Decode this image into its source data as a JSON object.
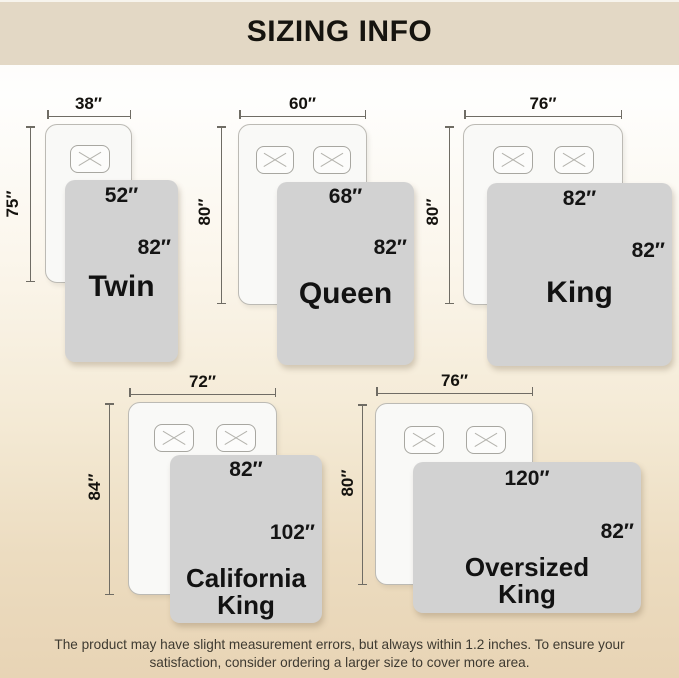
{
  "header": {
    "title": "SIZING INFO"
  },
  "sizes": [
    {
      "name": "Twin",
      "bed_width": "38″",
      "bed_height": "75″",
      "blanket_width": "52″",
      "blanket_height": "82″",
      "pillows": 1
    },
    {
      "name": "Queen",
      "bed_width": "60″",
      "bed_height": "80″",
      "blanket_width": "68″",
      "blanket_height": "82″",
      "pillows": 2
    },
    {
      "name": "King",
      "bed_width": "76″",
      "bed_height": "80″",
      "blanket_width": "82″",
      "blanket_height": "82″",
      "pillows": 2
    },
    {
      "name": "California King",
      "bed_width": "72″",
      "bed_height": "84″",
      "blanket_width": "82″",
      "blanket_height": "102″",
      "pillows": 2
    },
    {
      "name": "Oversized King",
      "bed_width": "76″",
      "bed_height": "80″",
      "blanket_width": "120″",
      "blanket_height": "82″",
      "pillows": 2
    }
  ],
  "footer": {
    "note_line1": "The product may have slight measurement errors, but always within 1.2 inches. To ensure your",
    "note_line2": "satisfaction, consider ordering a larger size to cover more area."
  },
  "colors": {
    "header_bg": "#e3d8c5",
    "page_bottom_beige": "#e8d4b5",
    "blanket_gray": "#d2d2d2",
    "bed_fill": "#f9f9f7",
    "text_dark": "#16140f"
  }
}
